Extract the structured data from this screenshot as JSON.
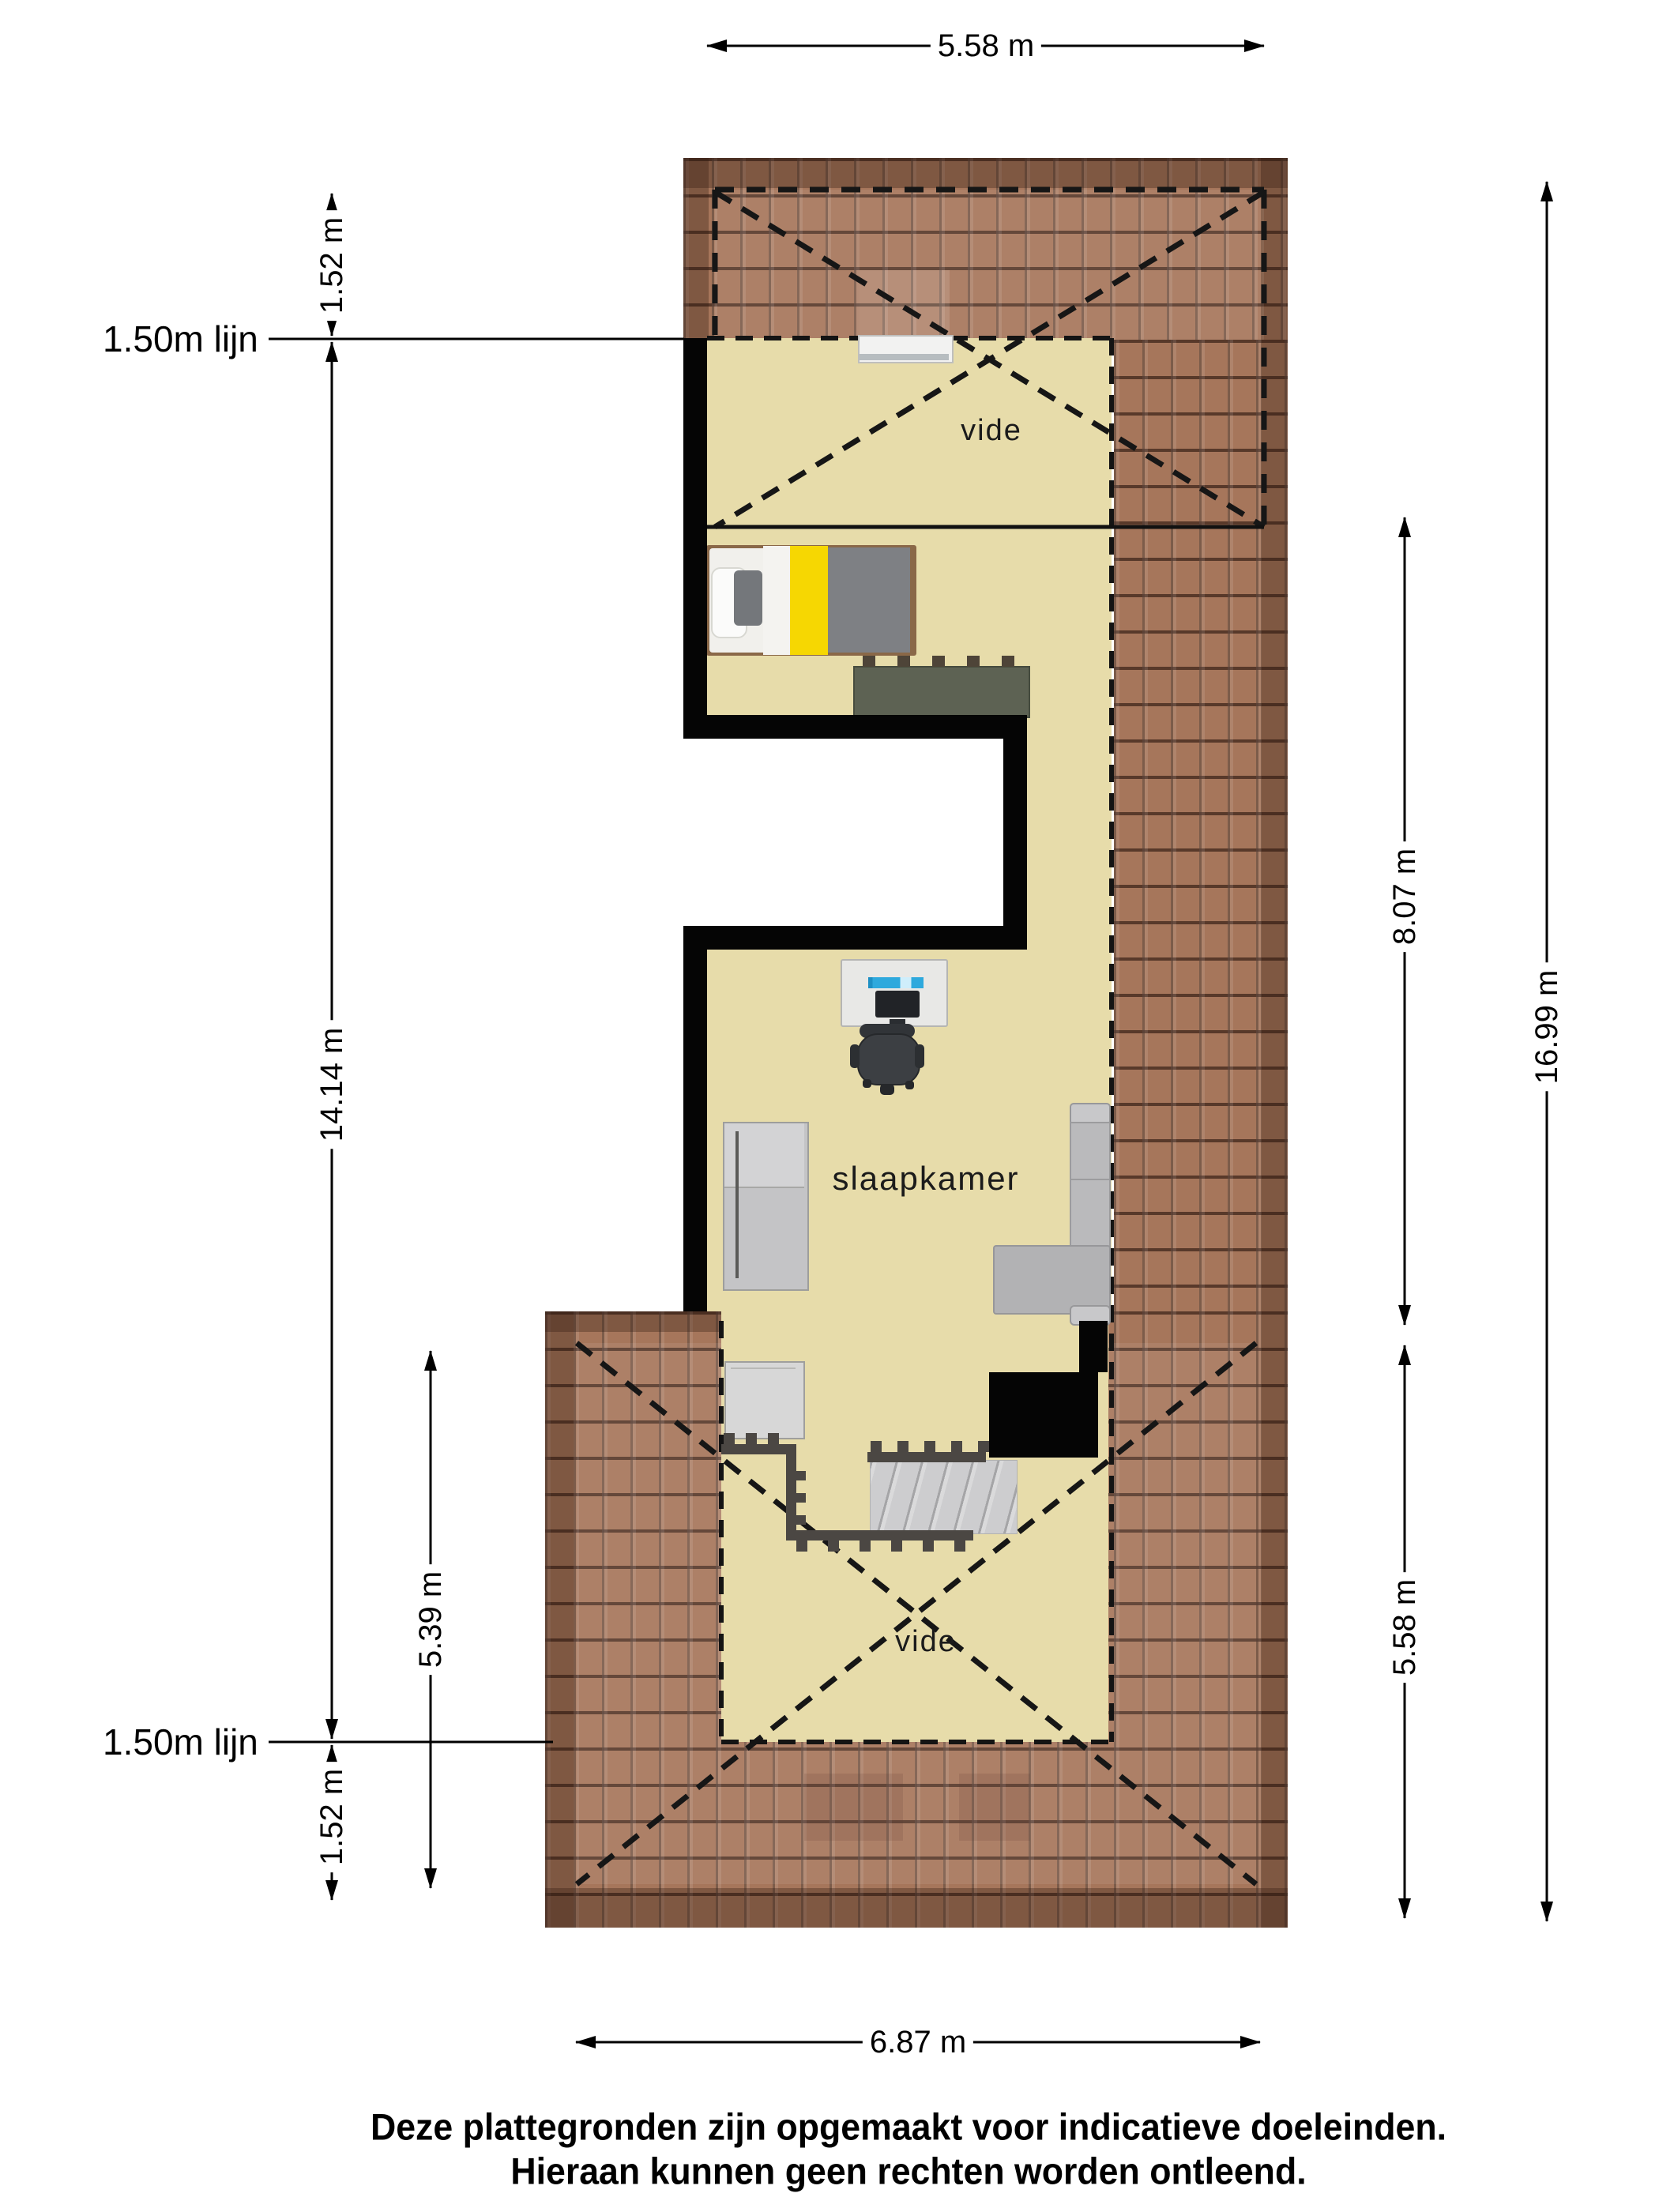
{
  "floorplan": {
    "rooms": [
      {
        "name": "vide-top",
        "label": "vide"
      },
      {
        "name": "slaapkamer",
        "label": "slaapkamer"
      },
      {
        "name": "vide-bottom",
        "label": "vide"
      }
    ],
    "dimensions": {
      "top_width": "5.58 m",
      "upper_left_height": "1.52 m",
      "left_total_height": "14.14 m",
      "lower_left_height": "5.39 m",
      "lower_left_small": "1.52 m",
      "right_upper": "8.07 m",
      "right_lower": "5.58 m",
      "right_total": "16.99 m",
      "bottom_width": "6.87 m"
    },
    "height_lines": {
      "top": "1.50m lijn",
      "bottom": "1.50m lijn"
    },
    "disclaimer": [
      "Deze plattegronden zijn opgemaakt voor indicatieve doeleinden.",
      "Hieraan kunnen geen rechten worden ontleend."
    ],
    "colors": {
      "floor": "#e7dcaa",
      "roof": "#a6765b",
      "roof_line": "#28140c",
      "wall": "#050505",
      "bed_yellow": "#f6d702",
      "duvet_gray": "#7e8084",
      "radiator_green": "#5d6253",
      "laptop_blue": "#2ea9dd",
      "sofa_gray": "#b2b2b4",
      "stairs_gray": "#cdcdcf",
      "railing_gray": "#4b4743"
    }
  }
}
